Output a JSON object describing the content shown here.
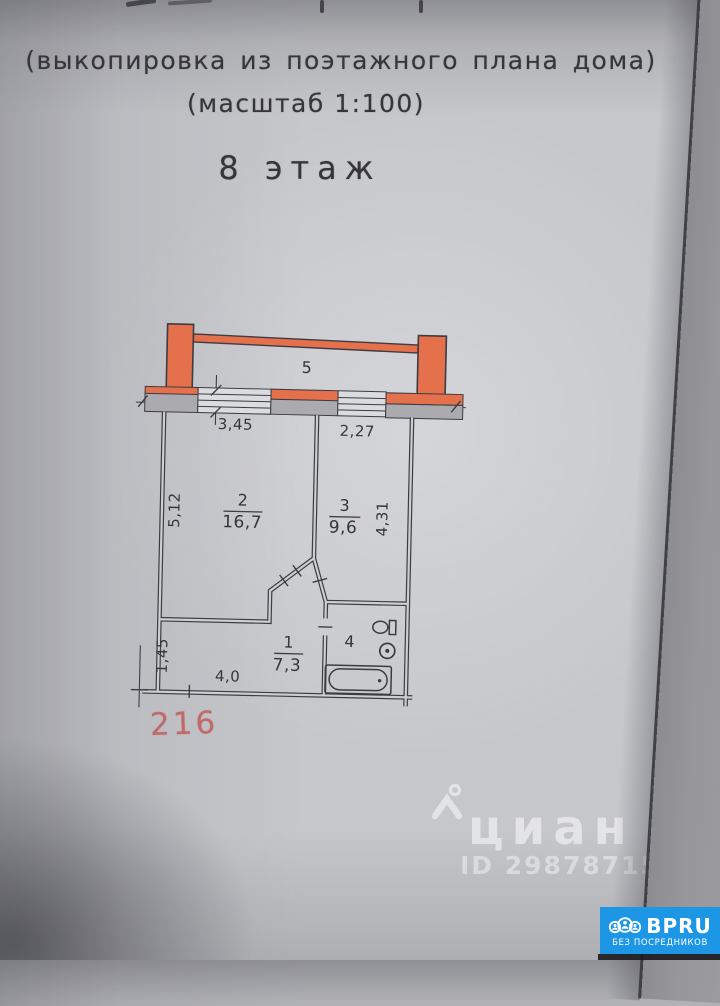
{
  "document": {
    "header_line1": "(выкопировка из поэтажного плана дома)",
    "header_line2": "(масштаб 1:100)",
    "floor_label": "8 этаж",
    "apartment_number": "216"
  },
  "plan": {
    "rooms": [
      {
        "number": "1",
        "area": "7,3"
      },
      {
        "number": "2",
        "area": "16,7"
      },
      {
        "number": "3",
        "area": "9,6"
      },
      {
        "number": "4",
        "area": ""
      },
      {
        "number": "5",
        "area": ""
      }
    ],
    "dimensions": {
      "top_left": "3,45",
      "top_right": "2,27",
      "left": "5,12",
      "right": "4,31",
      "hall_left": "1,45",
      "hall_bottom": "4,0"
    },
    "colors": {
      "balcony_orange": "#e4714b",
      "wall_gray": "#abaaae",
      "drawing_line": "#3c3c42",
      "apartment_number_red": "#c16a6a"
    }
  },
  "watermark": {
    "brand": "циан",
    "listing_id": "ID 298787159"
  },
  "badge": {
    "brand": "BPRU",
    "tagline": "БЕЗ ПОСРЕДНИКОВ",
    "background": "#1e96e6"
  }
}
